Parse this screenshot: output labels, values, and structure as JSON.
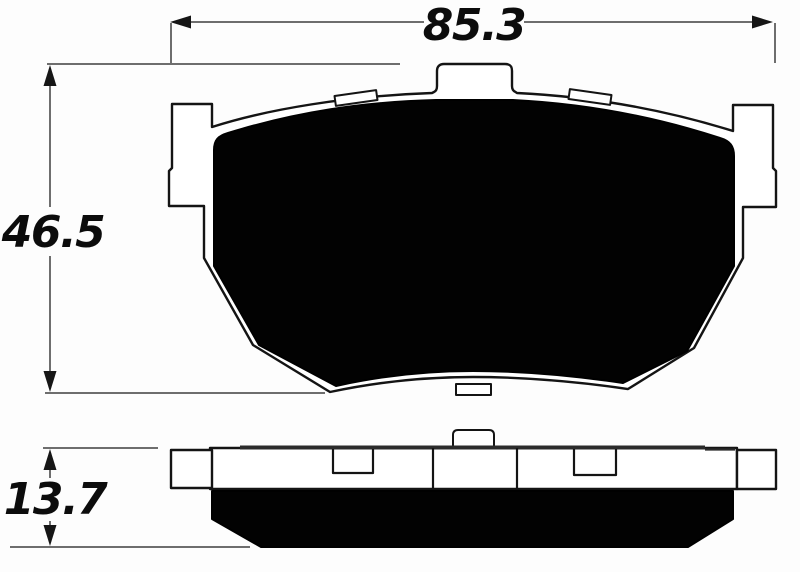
{
  "drawing": {
    "type": "technical-dimension-drawing",
    "subject": "disc brake pad",
    "views": {
      "front": "brake pad front profile with abutment ears, top mounting tab, shim clips and friction material",
      "side": "brake pad edge profile showing backing plate and friction material thickness"
    },
    "dimensions": {
      "overall_width": "85.3",
      "overall_height": "46.5",
      "overall_thickness": "13.7"
    },
    "colors": {
      "outline": "#141414",
      "friction_material": "#020202",
      "dimension_line": "#6e6e6e",
      "plate_fill": "#ffffff",
      "background": "#fdfdfd"
    }
  }
}
